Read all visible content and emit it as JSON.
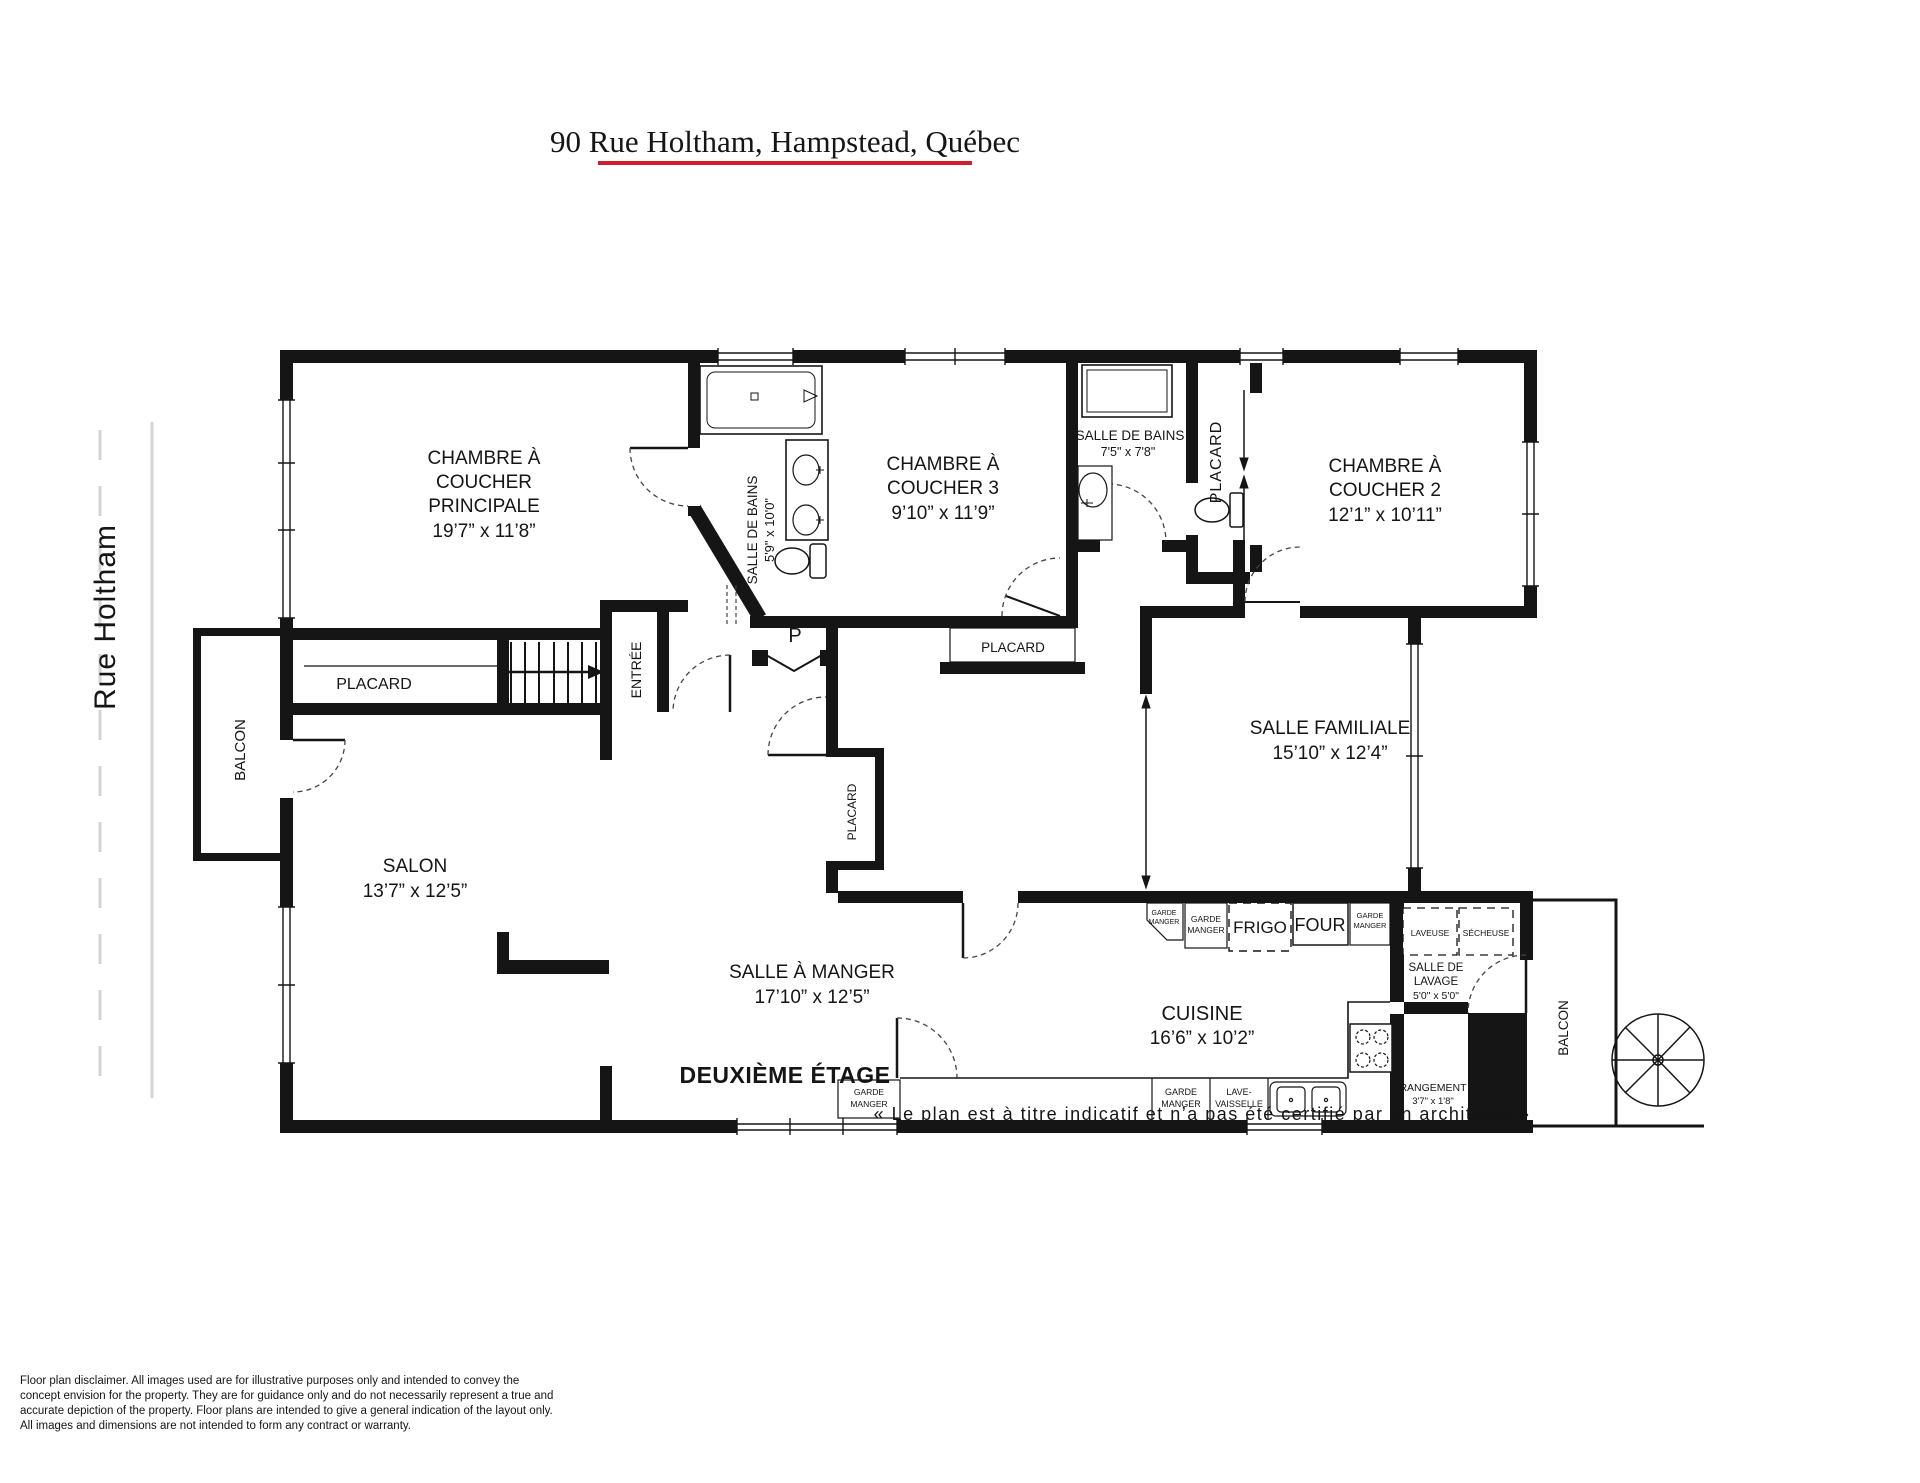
{
  "labels": {
    "title": "90 Rue Holtham, Hampstead, Québec",
    "street": "Rue Holtham",
    "floor": "DEUXIÈME ÉTAGE",
    "note": "« Le plan est à titre indicatif et n’a pas été certifié par un architecte »",
    "master1": "CHAMBRE À",
    "master2": "COUCHER",
    "master3": "PRINCIPALE",
    "master_dims": "19’7” x 11’8”",
    "bath1": "SALLE DE BAINS",
    "bath1_dims": "5'9\" x 10'0\"",
    "bed3_1": "CHAMBRE À",
    "bed3_2": "COUCHER 3",
    "bed3_dims": "9’10” x 11’9”",
    "bath2": "SALLE DE BAINS",
    "bath2_dims": "7'5\" x 7'8\"",
    "closet": "PLACARD",
    "bed2_1": "CHAMBRE À",
    "bed2_2": "COUCHER 2",
    "bed2_dims": "12’1” x 10’11”",
    "entry": "ENTRÉE",
    "p": "P",
    "family": "SALLE FAMILIALE",
    "family_dims": "15’10” x 12’4”",
    "balcony": "BALCON",
    "living": "SALON",
    "living_dims": "13’7” x 12’5”",
    "dining": "SALLE À MANGER",
    "dining_dims": "17’10” x 12’5”",
    "kitchen": "CUISINE",
    "kitchen_dims": "16’6” x 10’2”",
    "laundry1": "SALLE DE",
    "laundry2": "LAVAGE",
    "laundry_dims": "5'0\" x 5'0\"",
    "storage": "RANGEMENT",
    "storage_dims": "3'7\" x 1'8\"",
    "fridge": "FRIGO",
    "oven": "FOUR",
    "washer": "LAVEUSE",
    "dryer": "SÉCHEUSE",
    "pantry1": "GARDE",
    "pantry2": "MANGER",
    "dw1": "LAVE-",
    "dw2": "VAISSELLE"
  },
  "disclaimer": {
    "line1": "Floor plan disclaimer. All images used are for illustrative purposes only and intended to convey the",
    "line2": "concept envision for the property. They are for guidance only and do not necessarily represent a true and",
    "line3": "accurate depiction of the property. Floor plans are intended to give a general indication of the layout only.",
    "line4": "All images and dimensions are not intended to form any contract or warranty."
  },
  "accent_color": "#cf1f2e"
}
